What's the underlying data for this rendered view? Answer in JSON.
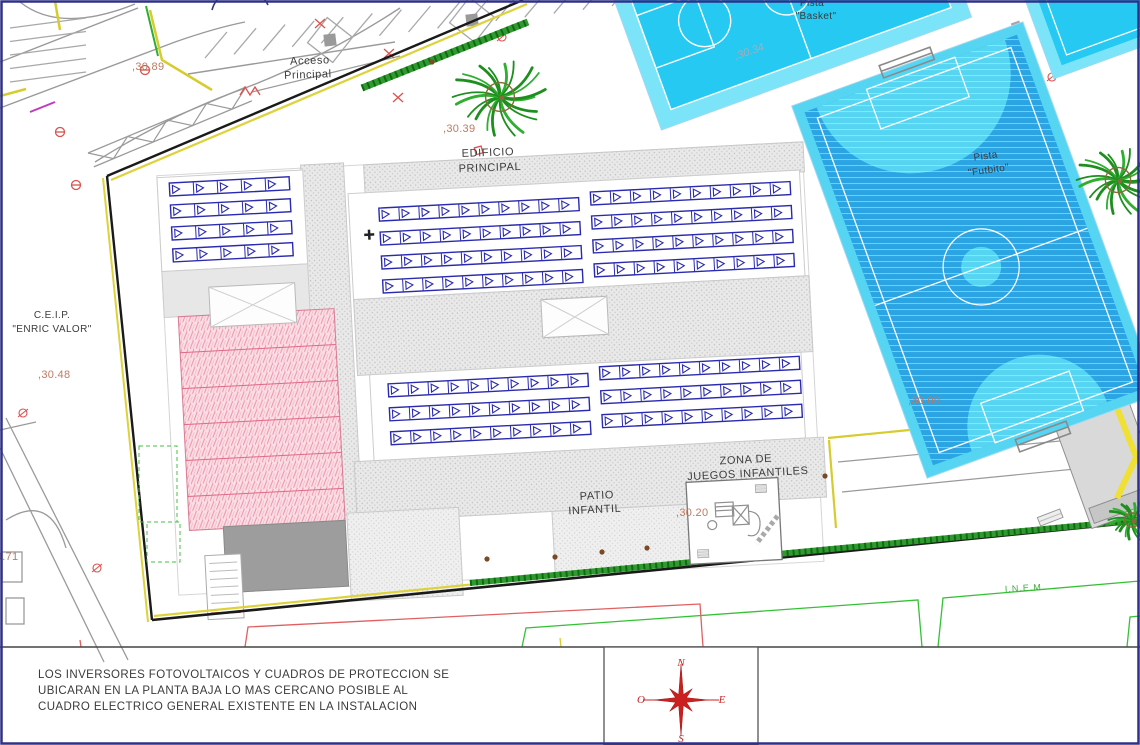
{
  "labels": {
    "acceso_line1": "Acceso",
    "acceso_line2": "Principal",
    "edificio_line1": "EDIFICIO",
    "edificio_line2": "PRINCIPAL",
    "ceip_line1": "C.E.I.P.",
    "ceip_line2": "\"ENRIC VALOR\"",
    "patio_line1": "PATIO",
    "patio_line2": "INFANTIL",
    "zona_line1": "ZONA DE",
    "zona_line2": "JUEGOS INFANTILES",
    "basket_line1": "Pista",
    "basket_line2": "\"Basket\"",
    "futbito_line1": "Pista",
    "futbito_line2": "\"Futbito\"",
    "inem": "I.N.E.M."
  },
  "elevations": {
    "acceso": ",30.89",
    "edificio": ",30.39",
    "ceip": ",30.48",
    "basket": ",30.34",
    "zona": ",30.20",
    "este": ",30.00",
    "oeste": ",29.71"
  },
  "note": {
    "line1": "LOS INVERSORES FOTOVOLTAICOS Y CUADROS DE PROTECCION SE",
    "line2": "UBICARAN EN LA PLANTA BAJA LO MAS CERCANO POSIBLE AL",
    "line3": "CUADRO ELECTRICO GENERAL EXISTENTE EN LA INSTALACION"
  },
  "compass": {
    "n": "N",
    "s": "S",
    "e": "E",
    "o": "O"
  },
  "solar_arrays": {
    "groups": [
      {
        "name": "roof-left",
        "rows": 4,
        "modules_per_row": 5
      },
      {
        "name": "roof-mid-upper-left",
        "rows": 4,
        "modules_per_row": 10
      },
      {
        "name": "roof-mid-upper-right",
        "rows": 4,
        "modules_per_row": 10
      },
      {
        "name": "roof-mid-lower-left",
        "rows": 3,
        "modules_per_row": 10
      },
      {
        "name": "roof-mid-lower-right",
        "rows": 3,
        "modules_per_row": 10
      }
    ]
  },
  "colors": {
    "court_basket": "#25c9f2",
    "court_futbito": "#2ba4e4",
    "court_light": "#55d5f2",
    "court_margin": "#7ce4f8",
    "panel_blue": "#2a2ab0",
    "hedge_green": "#2e9b2e",
    "boundary_yellow": "#ddd23a",
    "compass_red": "#cc2020",
    "elevation_brown": "#bd7a62",
    "inem_green": "#3cae3c",
    "frame_navy": "#2e3187"
  }
}
